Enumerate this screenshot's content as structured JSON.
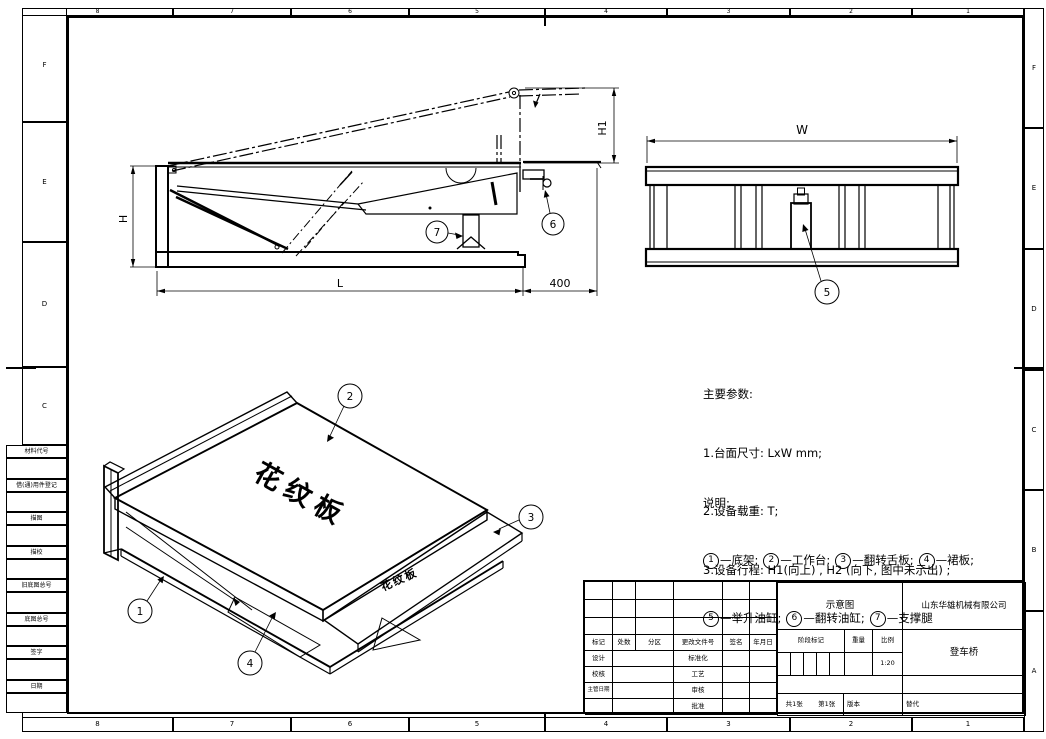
{
  "border": {
    "top_zones": [
      "8",
      "7",
      "6",
      "5",
      "4",
      "3",
      "2",
      "1"
    ],
    "bottom_zones": [
      "8",
      "7",
      "6",
      "5",
      "4",
      "3",
      "2",
      "1"
    ],
    "left_zones": [
      "F",
      "E",
      "D",
      "C"
    ],
    "right_zones": [
      "F",
      "E",
      "D",
      "C",
      "B",
      "A"
    ]
  },
  "margin_fields": {
    "f1": "材料代号",
    "f2": "借(通)用件登记",
    "f3": "描图",
    "f4": "描校",
    "f5": "旧底图总号",
    "f6": "底图总号",
    "f7": "签字",
    "f8": "日期"
  },
  "views": {
    "side": {
      "dim_h": "H",
      "dim_h1": "H1",
      "dim_l": "L",
      "dim_offset": "400",
      "balloon_support_leg": "7",
      "balloon_flip_cylinder": "6"
    },
    "front": {
      "dim_w": "W",
      "balloon_lift_cylinder": "5"
    },
    "iso": {
      "balloon_base": "1",
      "balloon_platform": "2",
      "balloon_lip": "3",
      "balloon_skirt": "4",
      "plate_text": "花纹板",
      "lip_plate_text": "花纹板"
    }
  },
  "notes": {
    "params_title": "主要参数:",
    "param_1": "1.台面尺寸: LxW mm;",
    "param_2": "2.设备载重: T;",
    "param_3": "3.设备行程: H1(向上) , H2 (向下, 图中未示出) ;",
    "legend_title": "说明:",
    "legend_sep": "—",
    "legend_end": ";",
    "legend": [
      {
        "num": "1",
        "label": "底架"
      },
      {
        "num": "2",
        "label": "工作台"
      },
      {
        "num": "3",
        "label": "翻转舌板"
      },
      {
        "num": "4",
        "label": "裙板"
      },
      {
        "num": "5",
        "label": "举升油缸"
      },
      {
        "num": "6",
        "label": "翻转油缸"
      },
      {
        "num": "7",
        "label": "支撑腿"
      }
    ]
  },
  "title_block": {
    "headers": {
      "mark": "标记",
      "count": "处数",
      "zone": "分区",
      "doc_no": "更改文件号",
      "sign": "签名",
      "date": "年月日"
    },
    "sign_labels": {
      "design": "设计",
      "check": "校核",
      "chief": "主管日期",
      "standard": "标准化",
      "process": "工艺",
      "audit": "审核",
      "approve": "批准"
    },
    "doc_type": "示意图",
    "company": "山东华雄机械有限公司",
    "stage_label": "阶段标记",
    "weight_label": "重量",
    "scale_label": "比例",
    "scale_value": "1:20",
    "product": "登车桥",
    "sheet_total": "共1张",
    "sheet_no": "第1张",
    "version_label": "版本",
    "replace_label": "替代"
  }
}
